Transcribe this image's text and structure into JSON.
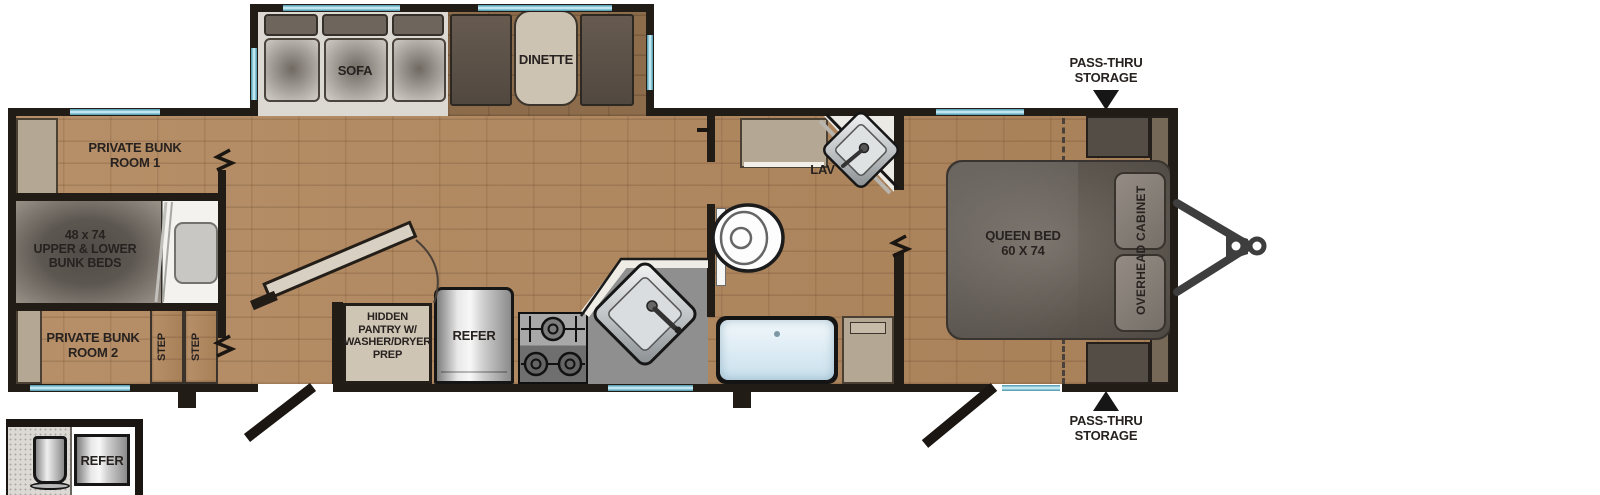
{
  "title": "Travel trailer floor plan",
  "colors": {
    "wall": "#221c17",
    "window_glass": "#7cc0d4",
    "wood_floor": "#b1875d",
    "cabinet_tan": "#b4a794",
    "label_text": "#272220"
  },
  "labels": {
    "sofa": "SOFA",
    "dinette": "DINETTE",
    "bunk_room_1": [
      "PRIVATE BUNK",
      "ROOM 1"
    ],
    "bunk_beds": [
      "48 x 74",
      "UPPER & LOWER",
      "BUNK BEDS"
    ],
    "bunk_room_2": [
      "PRIVATE BUNK",
      "ROOM 2"
    ],
    "step_1": "STEP",
    "step_2": "STEP",
    "pantry": [
      "HIDDEN",
      "PANTRY W/",
      "WASHER/DRYER",
      "PREP"
    ],
    "refer": "REFER",
    "lav": "LAV",
    "queen_bed": [
      "QUEEN BED",
      "60 X 74"
    ],
    "overhead_cabinet": "OVERHEAD CABINET",
    "pass_thru_top": [
      "PASS-THRU",
      "STORAGE"
    ],
    "pass_thru_bottom": [
      "PASS-THRU",
      "STORAGE"
    ],
    "inset_refer": "REFER"
  }
}
